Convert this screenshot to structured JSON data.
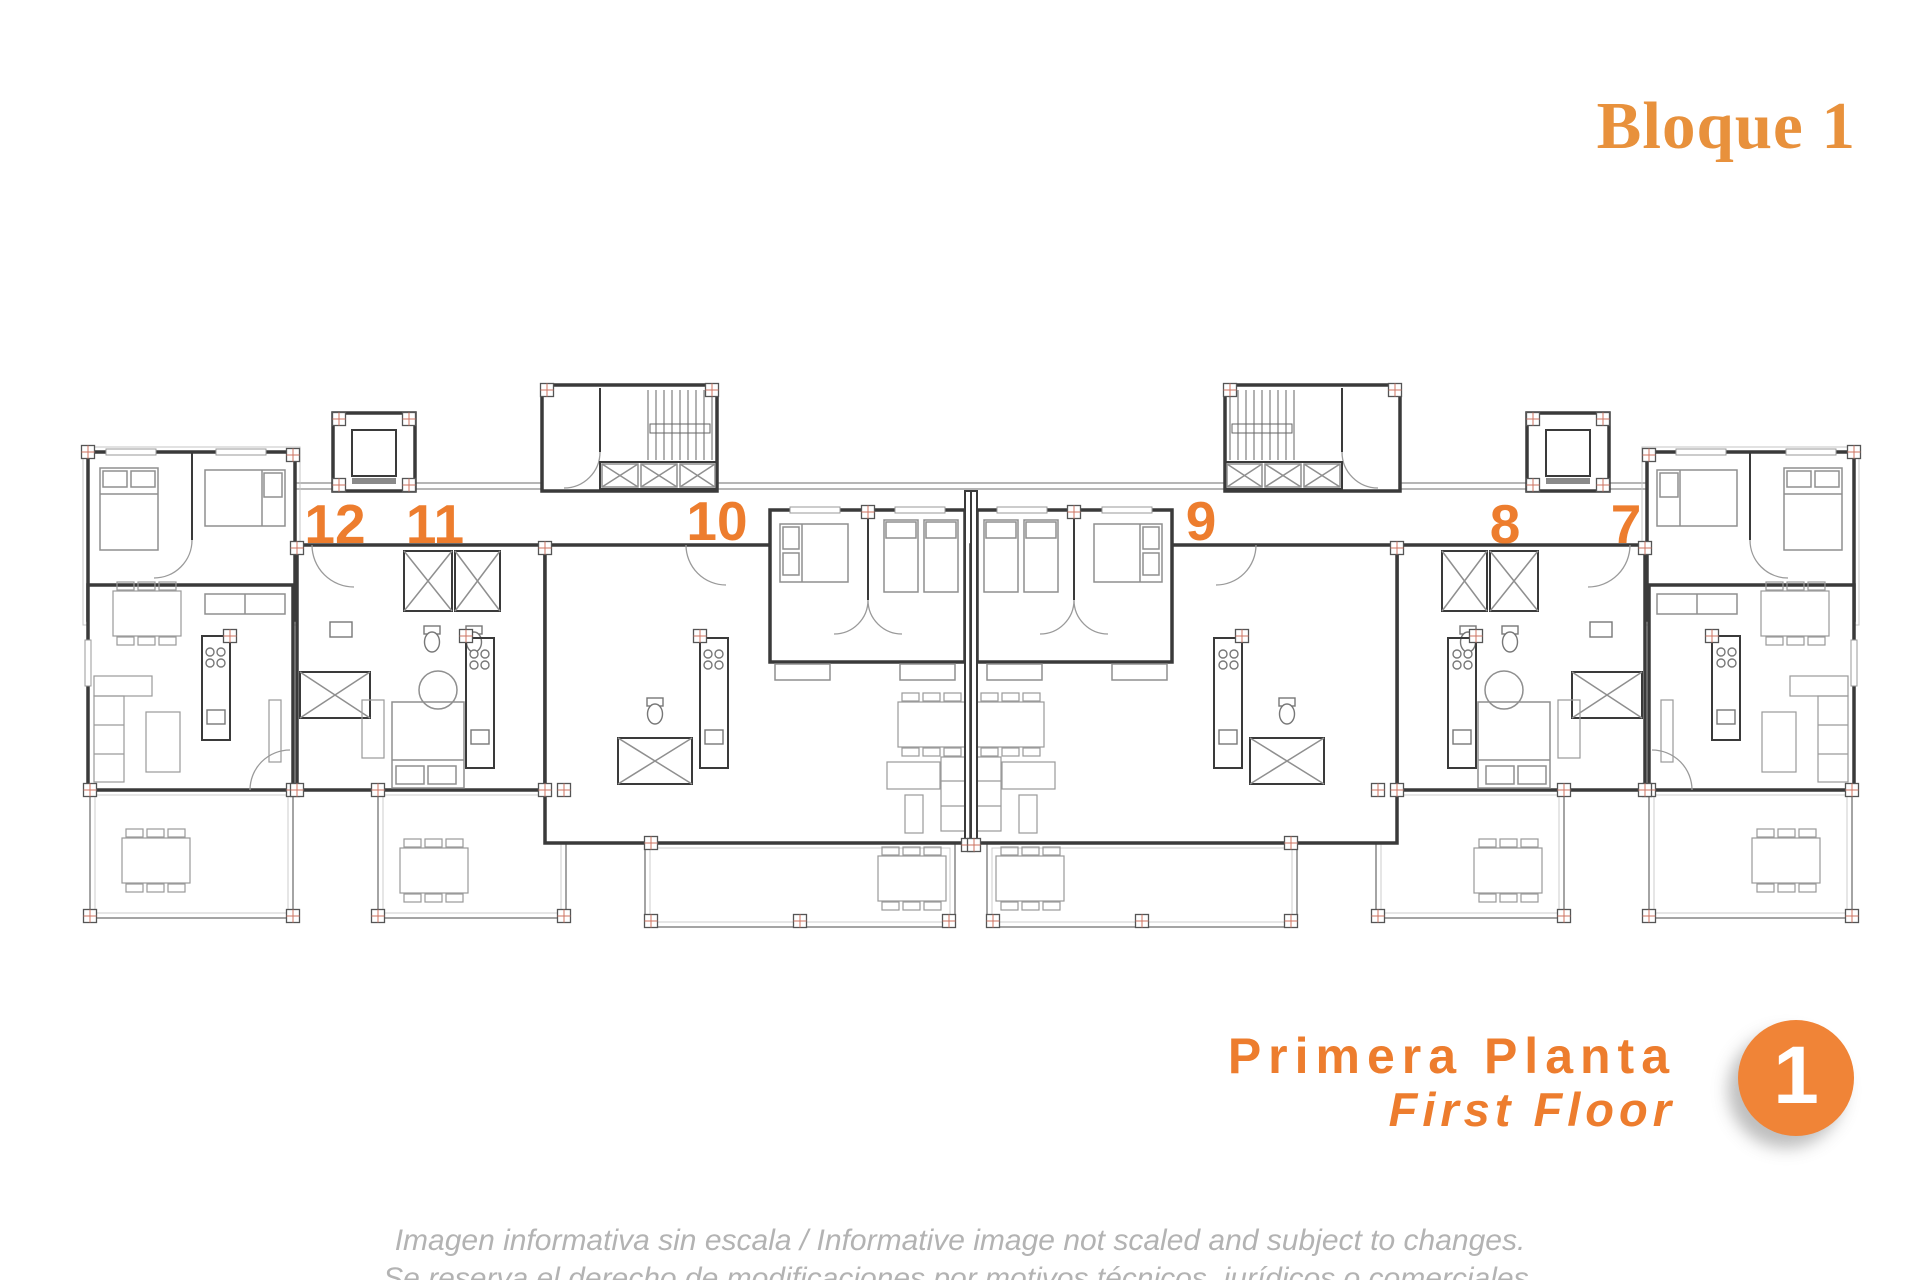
{
  "header": {
    "title": "Bloque 1"
  },
  "plan": {
    "units": [
      {
        "label": "12",
        "x": 335,
        "y": 497
      },
      {
        "label": "11",
        "x": 435,
        "y": 497
      },
      {
        "label": "10",
        "x": 717,
        "y": 494
      },
      {
        "label": "9",
        "x": 1201,
        "y": 494
      },
      {
        "label": "8",
        "x": 1505,
        "y": 497
      },
      {
        "label": "7",
        "x": 1626,
        "y": 497
      }
    ]
  },
  "footer": {
    "floor_name_es": "Primera Planta",
    "floor_name_en": "First Floor",
    "floor_badge": "1",
    "disclaimer_line1": "Imagen informativa sin escala /  Informative image not scaled and subject to changes.",
    "disclaimer_line2": "Se reserva el derecho de modificaciones por motivos técnicos, jurídicos o comerciales."
  },
  "colors": {
    "accent": "#ED7D2E",
    "title": "#E8913C",
    "badge": "#F08437",
    "muted": "#B3B3B3"
  }
}
